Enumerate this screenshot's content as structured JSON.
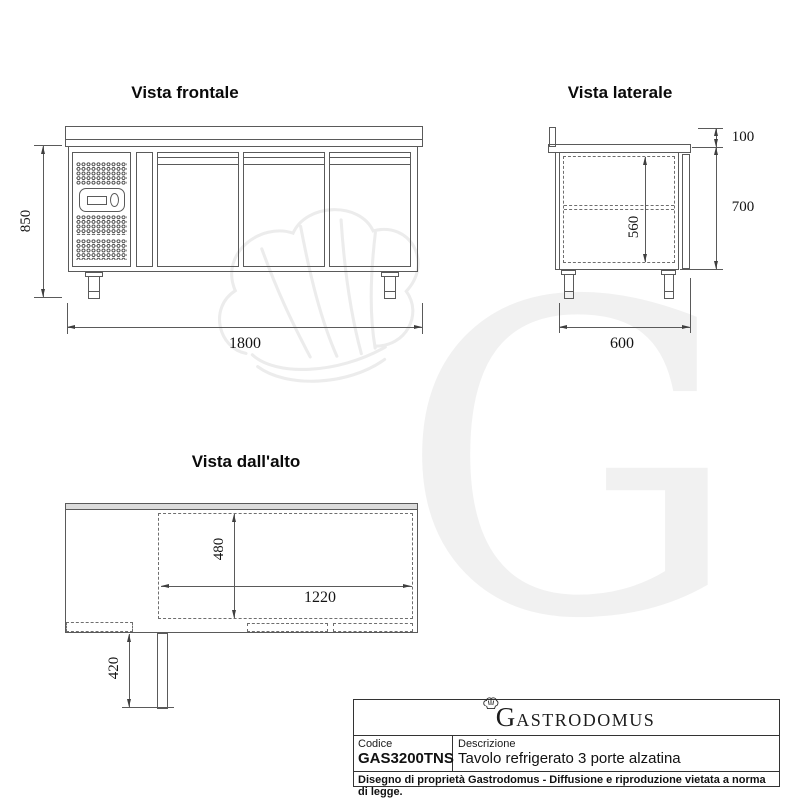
{
  "meta": {
    "background": "#ffffff",
    "line_color": "#5a5a5a",
    "band_fill": "#dcdcdc",
    "watermark_color": "#f1f1f1"
  },
  "watermark": {
    "letter": "G",
    "icon": "chef-hat"
  },
  "front_view": {
    "title": "Vista frontale",
    "dim_height": "850",
    "dim_width": "1800"
  },
  "side_view": {
    "title": "Vista laterale",
    "dim_backsplash": "100",
    "dim_height": "700",
    "dim_interior": "560",
    "dim_depth": "600"
  },
  "top_view": {
    "title": "Vista dall'alto",
    "dim_interior_depth": "480",
    "dim_interior_width": "1220",
    "dim_open_door": "420"
  },
  "title_block": {
    "logo_initial": "G",
    "logo_rest": "ASTRODOMUS",
    "codice_label": "Codice",
    "codice_value": "GAS3200TNS",
    "descrizione_label": "Descrizione",
    "descrizione_value": "Tavolo refrigerato 3 porte alzatina",
    "footer": "Disegno di proprietà Gastrodomus - Diffusione e riproduzione vietata a norma di legge."
  }
}
